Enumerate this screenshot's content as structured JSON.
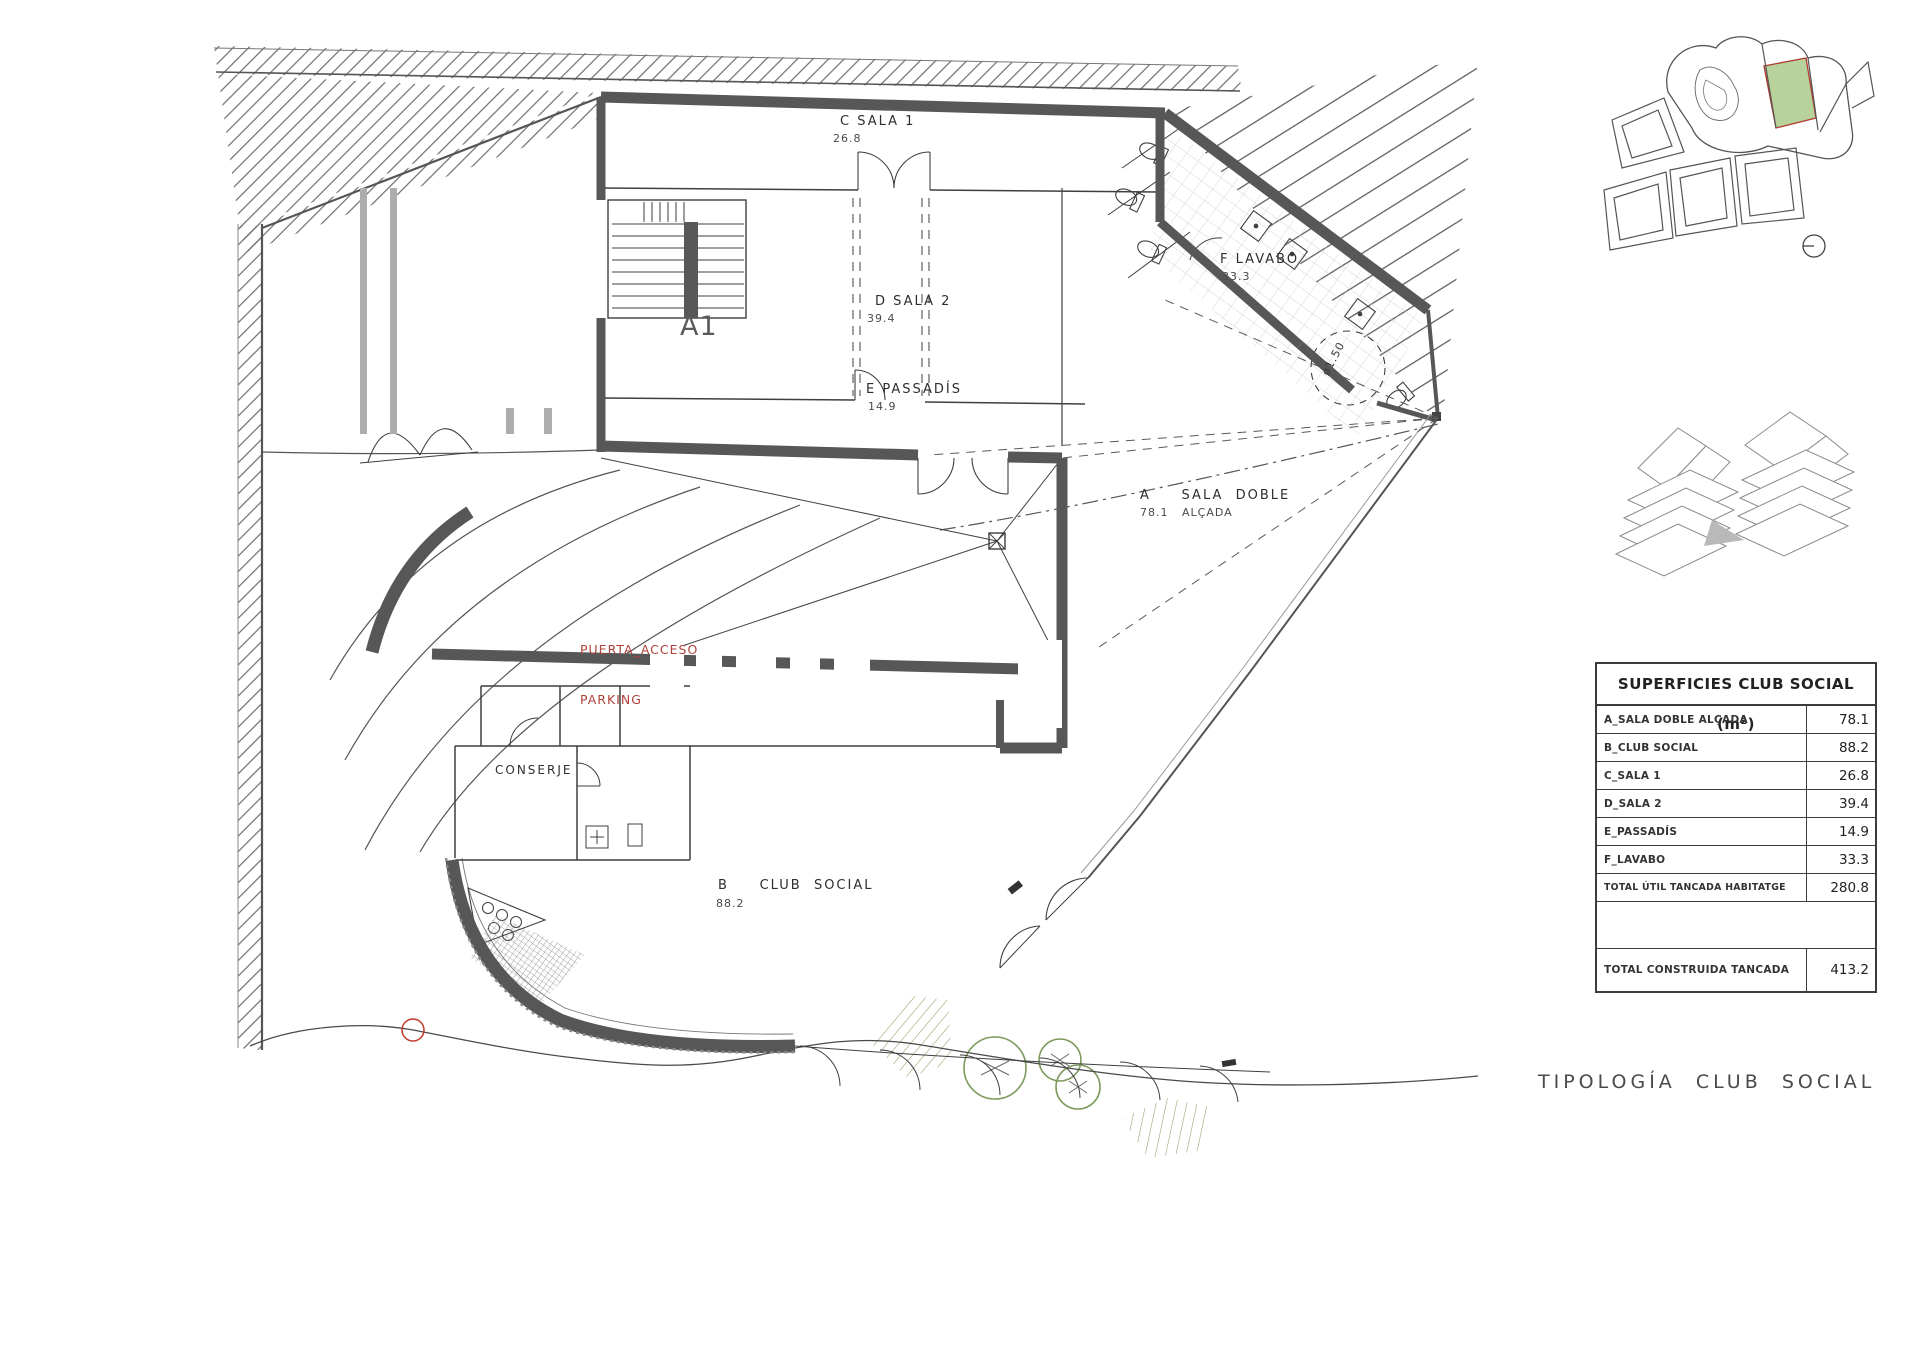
{
  "plan": {
    "rooms": {
      "sala1": {
        "name": "C SALA 1",
        "area": "26.8"
      },
      "sala2": {
        "name": "D SALA 2",
        "area": "39.4"
      },
      "lavabo": {
        "name": "F LAVABO",
        "area": "33.3"
      },
      "passadis": {
        "name": "E PASSADÍS",
        "area": "14.9"
      },
      "sala_doble_line1": "A     SALA  DOBLE",
      "sala_doble_line2": "78.1   ALÇADA",
      "club_social_line1": "B     CLUB  SOCIAL",
      "club_social_area": "88.2",
      "conserje": "CONSERJE"
    },
    "annotations": {
      "puerta_line1": "PUERTA_ACCESO",
      "puerta_line2": "PARKING",
      "section_marker": "A1",
      "turning_circle": "ø1.50"
    },
    "colors": {
      "annotation_red": "#b0423a",
      "vegetation_green": "#7d9a5c",
      "wall_gray": "#575757",
      "plot_highlight_green": "#b7d29a",
      "plot_highlight_border": "#b03a30"
    }
  },
  "table": {
    "title": "SUPERFICIES CLUB SOCIAL (m²)",
    "rows": [
      {
        "label": "A_SALA DOBLE ALÇADA",
        "value": "78.1"
      },
      {
        "label": "B_CLUB SOCIAL",
        "value": "88.2"
      },
      {
        "label": "C_SALA 1",
        "value": "26.8"
      },
      {
        "label": "D_SALA 2",
        "value": "39.4"
      },
      {
        "label": "E_PASSADÍS",
        "value": "14.9"
      },
      {
        "label": "F_LAVABO",
        "value": "33.3"
      },
      {
        "label": "TOTAL ÚTIL TANCADA HABITATGE",
        "value": "280.8"
      }
    ],
    "total_row": {
      "label": "TOTAL CONSTRUIDA TANCADA",
      "value": "413.2"
    }
  },
  "footer": {
    "sheet_title": "TIPOLOGÍA  CLUB  SOCIAL"
  }
}
